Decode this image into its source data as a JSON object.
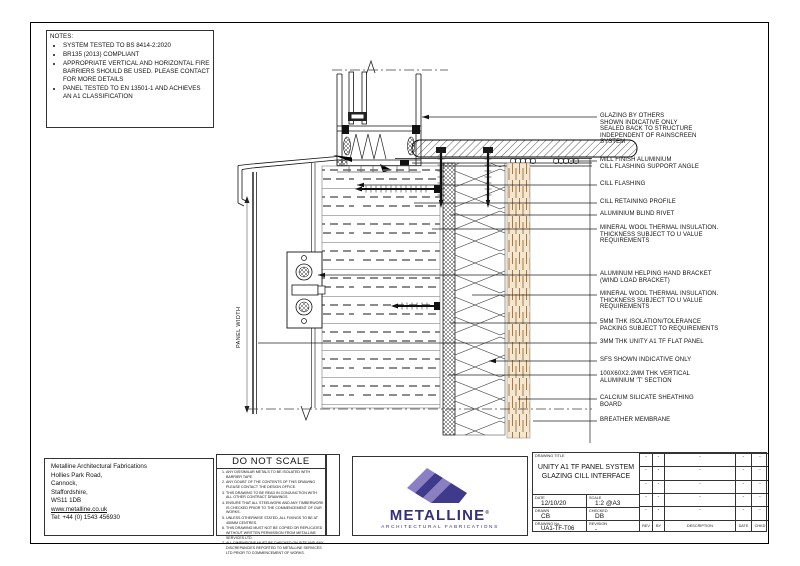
{
  "sheet": {
    "panel_width_label": "PANEL WIDTH"
  },
  "notes": {
    "title": "NOTES:",
    "items": [
      "SYSTEM TESTED TO BS 8414-2:2020",
      "BR135 (2013) COMPLIANT",
      "APPROPRIATE VERTICAL AND HORIZONTAL FIRE BARRIERS SHOULD BE USED. PLEASE CONTACT FOR MORE DETAILS",
      "PANEL TESTED TO EN 13501-1 AND ACHIEVES AN A1 CLASSIFICATION"
    ]
  },
  "callouts": [
    {
      "lines": [
        "GLAZING BY OTHERS",
        "SHOWN INDICATIVE ONLY",
        "SEALED BACK TO STRUCTURE",
        "INDEPENDENT OF RAINSCREEN",
        "SYSTEM"
      ]
    },
    {
      "lines": [
        "MILL FINISH ALUMINIUM",
        "CILL FLASHING SUPPORT ANGLE"
      ]
    },
    {
      "lines": [
        "CILL FLASHING"
      ]
    },
    {
      "lines": [
        "CILL RETAINING PROFILE"
      ]
    },
    {
      "lines": [
        "ALUMINIUM BLIND RIVET"
      ]
    },
    {
      "lines": [
        "MINERAL WOOL THERMAL INSULATION.",
        "THICKNESS SUBJECT TO U VALUE",
        "REQUIREMENTS"
      ]
    },
    {
      "lines": [
        "ALUMINUM HELPING HAND BRACKET",
        "(WIND LOAD BRACKET)"
      ]
    },
    {
      "lines": [
        "MINERAL WOOL THERMAL INSULATION.",
        "THICKNESS SUBJECT TO U VALUE",
        "REQUIREMENTS"
      ]
    },
    {
      "lines": [
        "5MM THK ISOLATION/TOLERANCE",
        "PACKING SUBJECT TO REQUIREMENTS"
      ]
    },
    {
      "lines": [
        "3MM THK UNITY A1 TF FLAT PANEL"
      ]
    },
    {
      "lines": [
        "SFS SHOWN INDICATIVE ONLY"
      ]
    },
    {
      "lines": [
        "100X60X2.2MM THK VERTICAL",
        "ALUMINIUM 'T' SECTION"
      ]
    },
    {
      "lines": [
        "CALCIUM SILICATE SHEATHING",
        "BOARD"
      ]
    },
    {
      "lines": [
        "BREATHER MEMBRANE"
      ]
    }
  ],
  "footer": {
    "company": {
      "name": "Metalline Architectural Fabrications",
      "address_lines": [
        "Hollies Park Road,",
        "Cannock,",
        "Staffordshire,",
        "WS11 1DB"
      ],
      "website": "www.metalline.co.uk",
      "phone": "Tel: +44 (0) 1543 456930"
    },
    "do_not_scale": {
      "title": "DO NOT SCALE",
      "items": [
        "ANY DISSIMILAR METALS TO BE ISOLATED WITH BARRIER TAPE.",
        "ANY DOUBT OF THE CONTENTS OF THIS DRAWING PLEASE CONTACT THE DESIGN OFFICE.",
        "THIS DRAWING TO BE READ IN CONJUNCTION WITH ALL OTHER CONTRACT DRAWINGS.",
        "ENSURE THAT ALL STEELWORK AND ANY TIMBERWORK IS CHECKED PRIOR TO THE COMMENCEMENT OF OUR WORKS.",
        "UNLESS OTHERWISE STATED, ALL FIXINGS TO BE AT 450MM CENTRES.",
        "THIS DRAWING MUST NOT BE COPIED OR REPLICATED WITHOUT WRITTEN PERMISSION FROM METALLINE SERVICES LTD.",
        "ALL DIMENSIONS MUST BE CHECKED ON SITE AND ANY DISCREPANCIES REPORTED TO METALLINE SERVICES LTD PRIOR TO COMMENCEMENT OF WORKS."
      ]
    },
    "logo": {
      "name": "METALLINE",
      "registered_mark": "®",
      "tagline": "ARCHITECTURAL FABRICATIONS"
    },
    "title_block": {
      "drawing_title_label": "DRAWING TITLE",
      "drawing_title_lines": [
        "UNITY A1 TF PANEL SYSTEM",
        "GLAZING CILL INTERFACE"
      ],
      "date_label": "DATE",
      "date_value": "12/10/20",
      "scale_label": "SCALE",
      "scale_value": "1:2 @A3",
      "drawn_label": "DRAWN",
      "drawn_value": "CB",
      "checked_label": "CHECKED",
      "checked_value": "DB",
      "drawing_no_label": "DRAWING No.",
      "drawing_no_value": "UA1-TF-T06",
      "revision_label": "REVISION",
      "revision_value": "-",
      "revision_table": {
        "headers": [
          "REV",
          "BY",
          "DESCRIPTION",
          "DATE",
          "CHKD"
        ],
        "rows": [
          [
            "-",
            "-",
            "-",
            "-",
            "-"
          ],
          [
            "-",
            "-",
            "-",
            "-",
            "-"
          ],
          [
            "-",
            "-",
            "-",
            "-",
            "-"
          ],
          [
            "-",
            "-",
            "-",
            "-",
            "-"
          ],
          [
            "-",
            "-",
            "-",
            "-",
            "-"
          ]
        ]
      }
    }
  },
  "colors": {
    "line": "#1a1a1a",
    "board_fill": "#f4e7d2",
    "board_grain": "#a9793f",
    "logo_purple": "#3a3284",
    "logo_light": "#8a7fc0"
  }
}
